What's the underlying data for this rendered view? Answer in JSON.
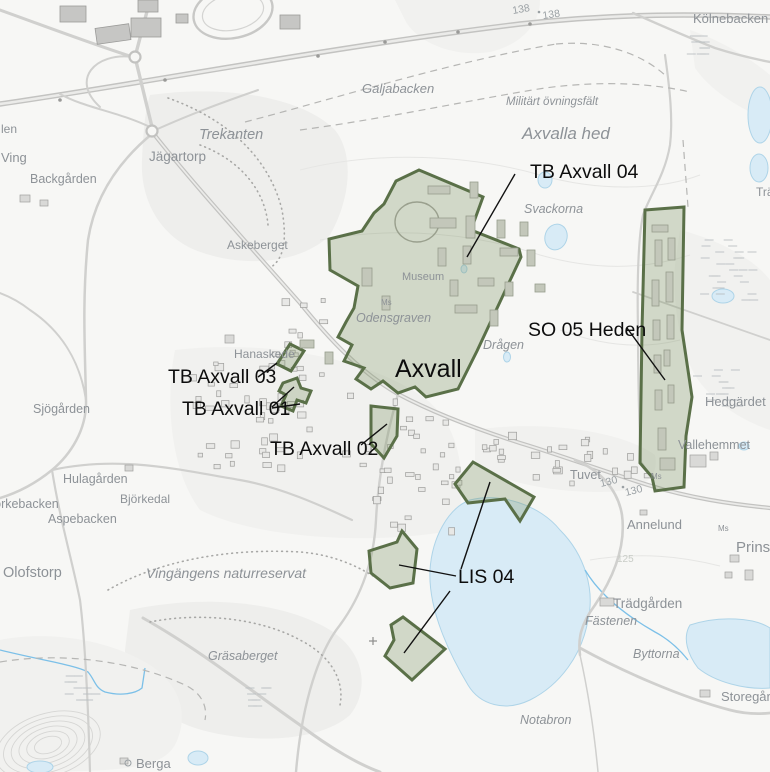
{
  "title": "Axvall planning map",
  "colors": {
    "zone_fill": "rgba(124,146,96,0.30)",
    "zone_border": "#5a7048",
    "water": "#d8ebf6",
    "place_label": "#8d9297",
    "zone_label": "#0d0d0d",
    "background": "#f7f7f5"
  },
  "town_label": "Axvall",
  "zones": [
    {
      "id": "tb-axvall-04",
      "label": "TB Axvall 04"
    },
    {
      "id": "so-05-heden",
      "label": "SO 05 Heden"
    },
    {
      "id": "tb-axvall-03",
      "label": "TB Axvall 03"
    },
    {
      "id": "tb-axvall-01",
      "label": "TB Axvall 01"
    },
    {
      "id": "tb-axvall-02",
      "label": "TB Axvall 02"
    },
    {
      "id": "lis-04",
      "label": "LIS 04"
    }
  ],
  "places": [
    {
      "name": "Kölnebacken"
    },
    {
      "name": "Galjabacken"
    },
    {
      "name": "Militärt övningsfält"
    },
    {
      "name": "Axvalla hed"
    },
    {
      "name": "Trekanten"
    },
    {
      "name": "Jägartorp"
    },
    {
      "name": "Backgården"
    },
    {
      "name": "Askeberget"
    },
    {
      "name": "Svackorna"
    },
    {
      "name": "Museum"
    },
    {
      "name": "Odensgraven"
    },
    {
      "name": "Drågen"
    },
    {
      "name": "Hedgärdet"
    },
    {
      "name": "Vallehemmet"
    },
    {
      "name": "Hanaskede"
    },
    {
      "name": "Tuvet"
    },
    {
      "name": "Annelund"
    },
    {
      "name": "Prinshaga"
    },
    {
      "name": "Trädgården"
    },
    {
      "name": "Fästenen"
    },
    {
      "name": "Byttorna"
    },
    {
      "name": "Storegården"
    },
    {
      "name": "Notabron"
    },
    {
      "name": "Gräsaberget"
    },
    {
      "name": "Berga"
    },
    {
      "name": "Olofstorp"
    },
    {
      "name": "Sjögården"
    },
    {
      "name": "Hulagården"
    },
    {
      "name": "Björkebacken"
    },
    {
      "name": "Björkedal"
    },
    {
      "name": "Aspebacken"
    },
    {
      "name": "Vingängens naturreservat"
    },
    {
      "name": "Ving"
    },
    {
      "name": "len"
    },
    {
      "name": "Ms"
    },
    {
      "name": "Ms"
    },
    {
      "name": "Ms"
    },
    {
      "name": "Trä"
    }
  ],
  "road_labels": [
    {
      "text": "138"
    },
    {
      "text": "138"
    },
    {
      "text": "130"
    },
    {
      "text": "130"
    },
    {
      "text": "125"
    }
  ]
}
